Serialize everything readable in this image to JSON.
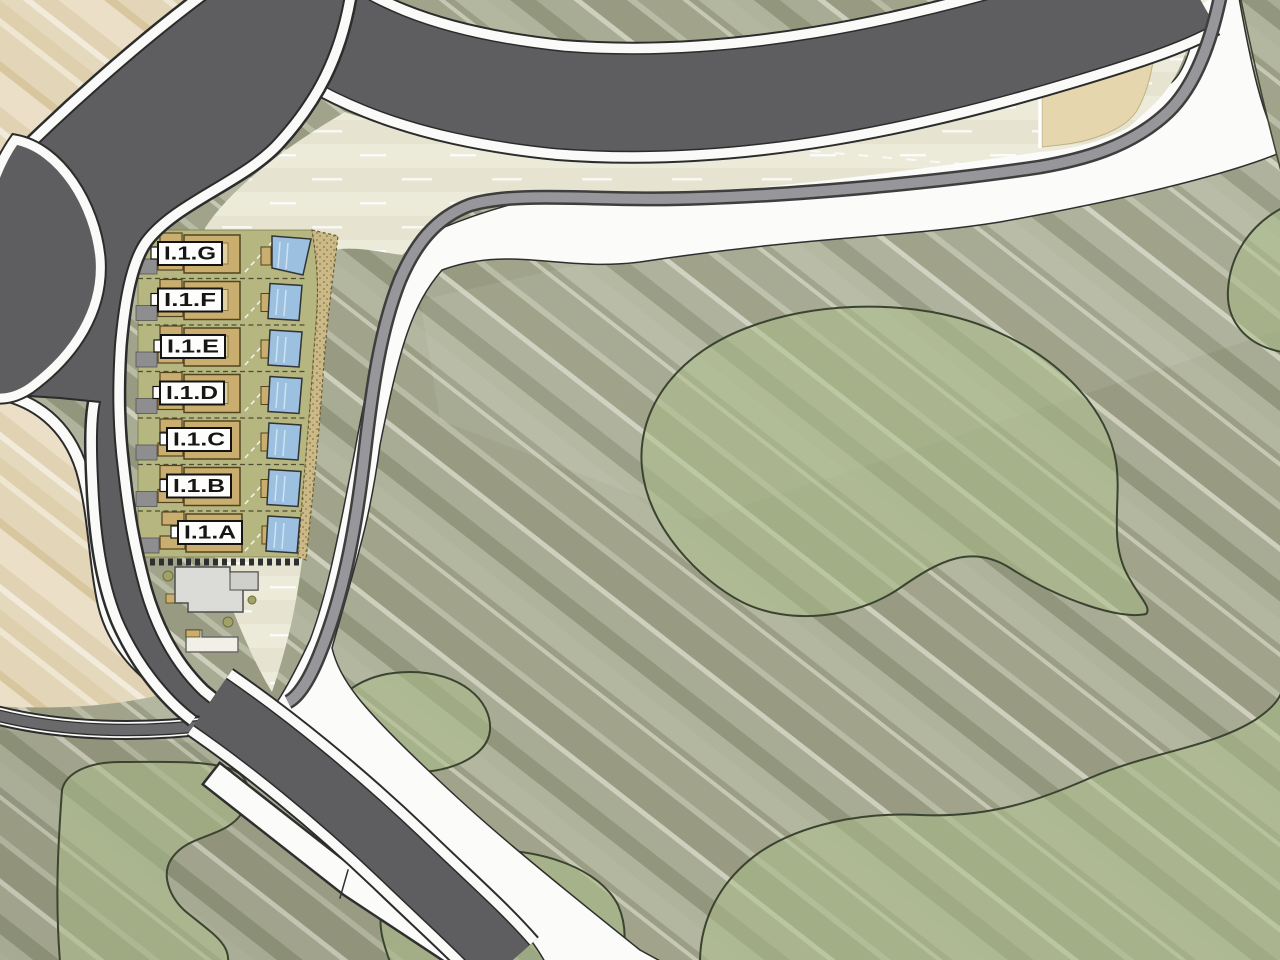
{
  "plan": {
    "villas": [
      {
        "label": "I.1.G"
      },
      {
        "label": "I.1.F"
      },
      {
        "label": "I.1.E"
      },
      {
        "label": "I.1.D"
      },
      {
        "label": "I.1.C"
      },
      {
        "label": "I.1.B"
      },
      {
        "label": "I.1.A"
      }
    ],
    "colors": {
      "road": "#5e5e61",
      "road_outline": "#2b2b2b",
      "path_white": "#fbfbf9",
      "promenade_gray": "#97979b",
      "sand": "#e7dcc2",
      "cream_parcel": "#ecead9",
      "tan_parcel": "#e6d6ae",
      "green_base": "#a7aa92",
      "green_blob": "#a9bd8a",
      "villa_building": "#c9ae6f",
      "villa_yard": "#b6b680",
      "pool_blue": "#9cc0e0",
      "existing_building_gray": "#dbdbd8"
    },
    "regions": {
      "northwest": "sand-dunes",
      "southwest": "sand-roundabout",
      "center_left": "villa-plots",
      "east": "landscaped-park"
    }
  }
}
